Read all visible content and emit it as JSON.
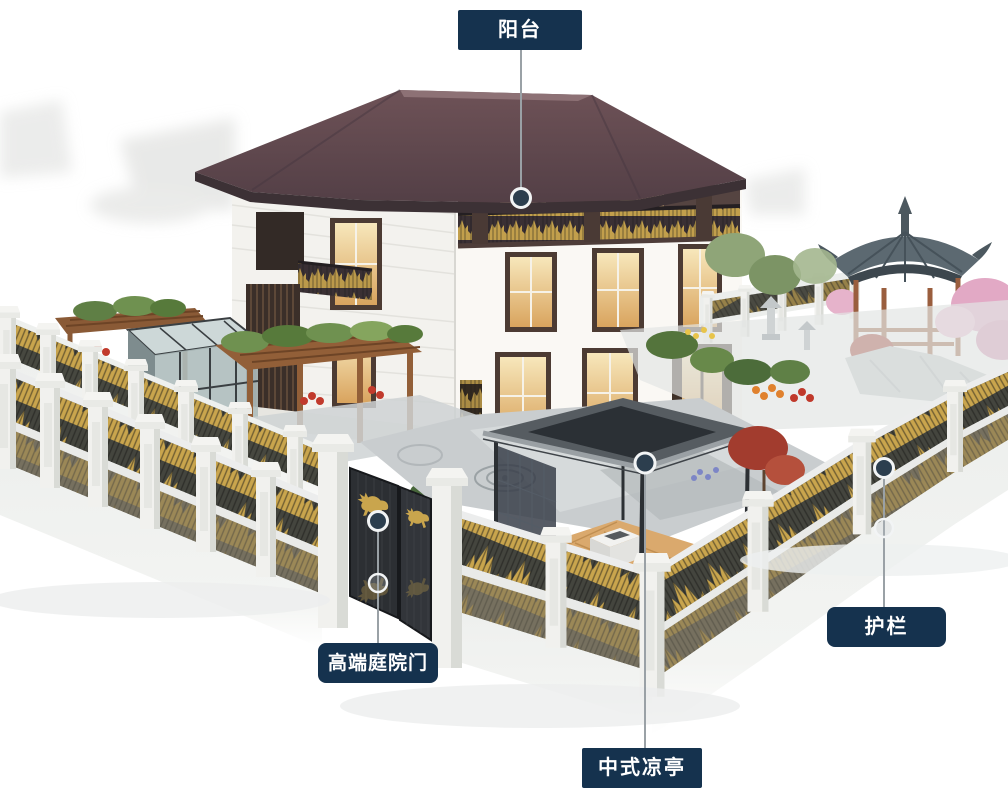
{
  "callouts": {
    "balcony": {
      "label": "阳台"
    },
    "gate": {
      "label": "高端庭院门"
    },
    "pavilion": {
      "label": "中式凉亭"
    },
    "guardrail": {
      "label": "护栏"
    }
  },
  "colors": {
    "label_bg": "#15324E",
    "label_text": "#FFFFFF",
    "callout_line": "#9AA1A6",
    "marker_fill": "#2C3E4E",
    "marker_ring": "#F2F4F5",
    "accent_gold": "#C6A44C",
    "roof_maroon": "#5E464C",
    "gazebo_roof": "#5C6971",
    "wall_white": "#F4F3EF",
    "background": "#FFFFFF"
  }
}
